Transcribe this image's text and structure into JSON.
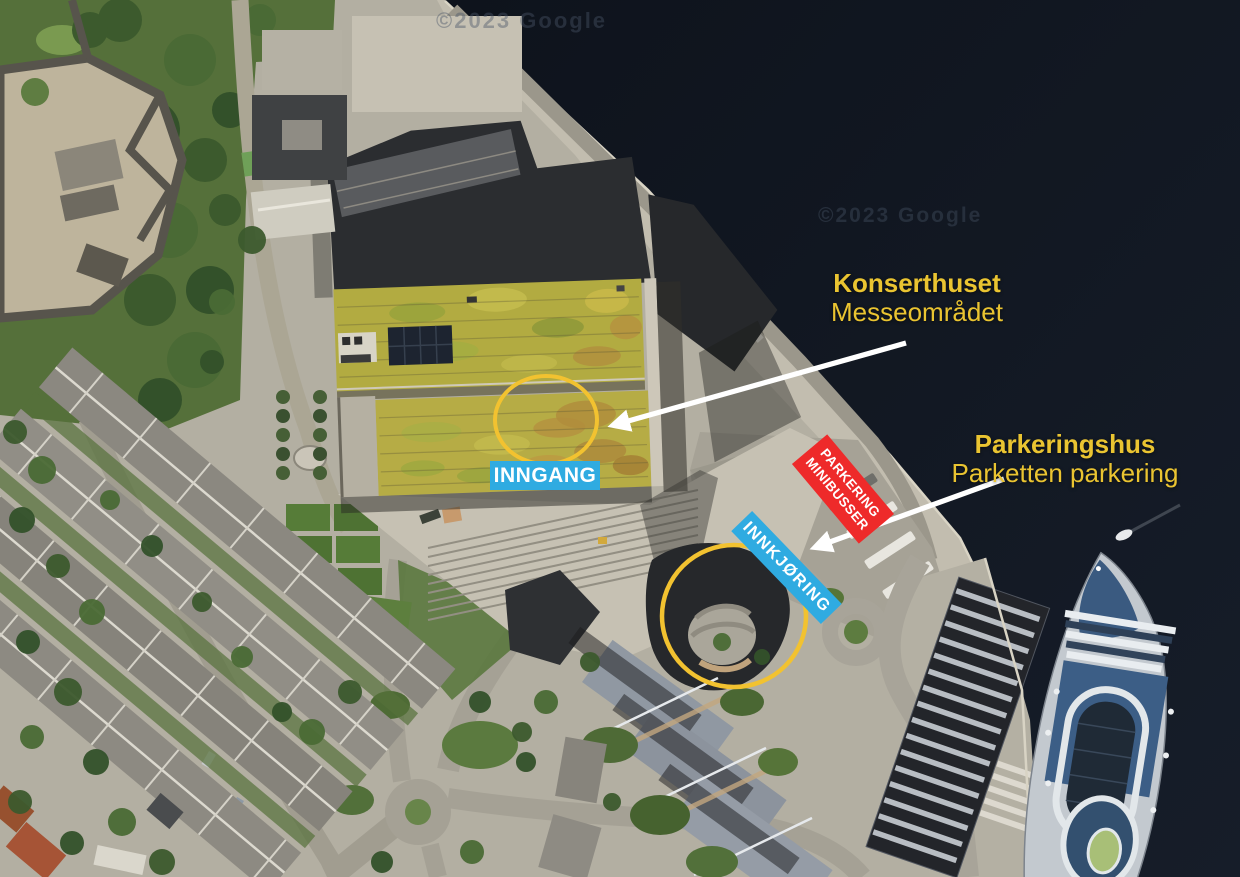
{
  "watermarks": {
    "top": "©2023 Google",
    "center": "©2023 Google"
  },
  "labels": {
    "konserthuset": {
      "title": "Konserthuset",
      "subtitle": "Messeområdet"
    },
    "parkeringshus": {
      "title": "Parkeringshus",
      "subtitle": "Parketten parkering"
    }
  },
  "badges": {
    "inngang": "INNGANG",
    "innkjoring": "INNKJØRING",
    "parkering_minibusser": {
      "line1": "PARKERING",
      "line2": "MINIBUSSER"
    }
  },
  "colors": {
    "label_yellow": "#eac431",
    "badge_blue": "#2fabe1",
    "badge_red": "#ee2a2a",
    "highlight_circle": "#f2c230",
    "arrow": "#ffffff"
  }
}
